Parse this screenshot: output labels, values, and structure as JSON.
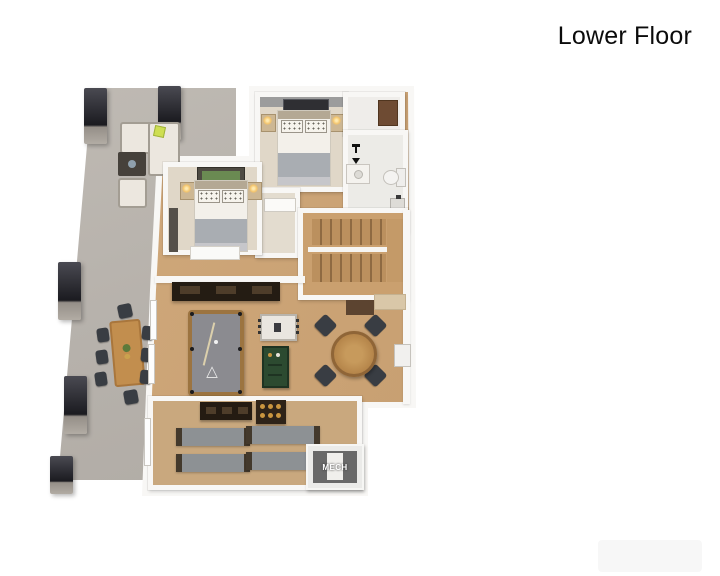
{
  "page": {
    "title": "Lower Floor",
    "background": "#ffffff"
  },
  "plan": {
    "mech_label": "MECH",
    "colors": {
      "patio_concrete": "#b6b1ab",
      "wood_floor": "#c9a173",
      "carpet": "#e0d7c8",
      "bathroom_tile": "#ecebe7",
      "wall_white": "#f8f7f5",
      "unfinished_gray": "#e9e9eb",
      "pool_table_felt": "#8b8b90",
      "pool_table_rail": "#9c7440",
      "structural_post": "#1b1b20",
      "bunk_platform": "#8d9194",
      "dart_cabinet_green": "#2c4a30",
      "accent_pillow_green": "#cede52",
      "mech_room_gray": "#696969",
      "bar_console_dark": "#241c13",
      "outdoor_table_wood": "#c28e4e"
    },
    "elements": [
      "patio",
      "outdoor-lounge",
      "outdoor-dining",
      "structural-posts",
      "bedroom-upper",
      "bedroom-lower",
      "closet",
      "bathroom",
      "stairs",
      "game-room",
      "bar-console",
      "pool-table",
      "game-table",
      "dart-cabinet",
      "poker-table",
      "wet-bar",
      "mini-fridge",
      "bunk-room",
      "media-console",
      "shelf-unit",
      "bunk-platforms",
      "mech-room",
      "unfinished-area"
    ]
  }
}
